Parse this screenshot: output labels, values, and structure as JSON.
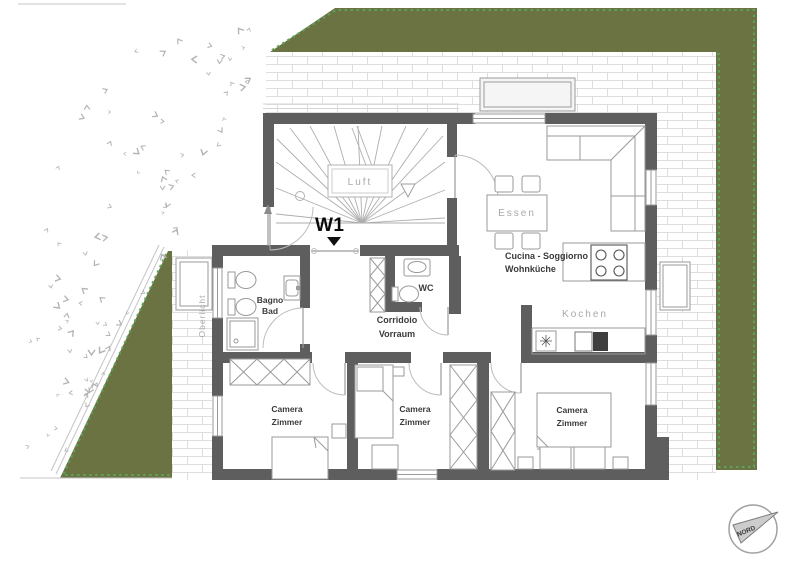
{
  "plan": {
    "unit_label": "W1",
    "labels": {
      "stairs": "Luft",
      "bath1": "Bagno",
      "bath2": "Bad",
      "corridor1": "Corridoio",
      "corridor2": "Vorraum",
      "wc": "WC",
      "living1": "Cucina - Soggiorno",
      "living2": "Wohnküche",
      "dining": "Essen",
      "cooking": "Kochen",
      "bed_left1": "Camera",
      "bed_left2": "Zimmer",
      "bed_mid1": "Camera",
      "bed_mid2": "Zimmer",
      "bed_right1": "Camera",
      "bed_right2": "Zimmer",
      "skylight": "Oberlicht",
      "compass": "NORD"
    },
    "colors": {
      "wall": "#5e5e5e",
      "grass": "#6c7342",
      "grass_border": "#5aa55c",
      "tile_joint": "#dedede",
      "furniture": "#9a9a9a",
      "label_muted": "#a8a8a8",
      "label_dark": "#3b3b3b",
      "unit_label": "#0a0a0a"
    }
  }
}
